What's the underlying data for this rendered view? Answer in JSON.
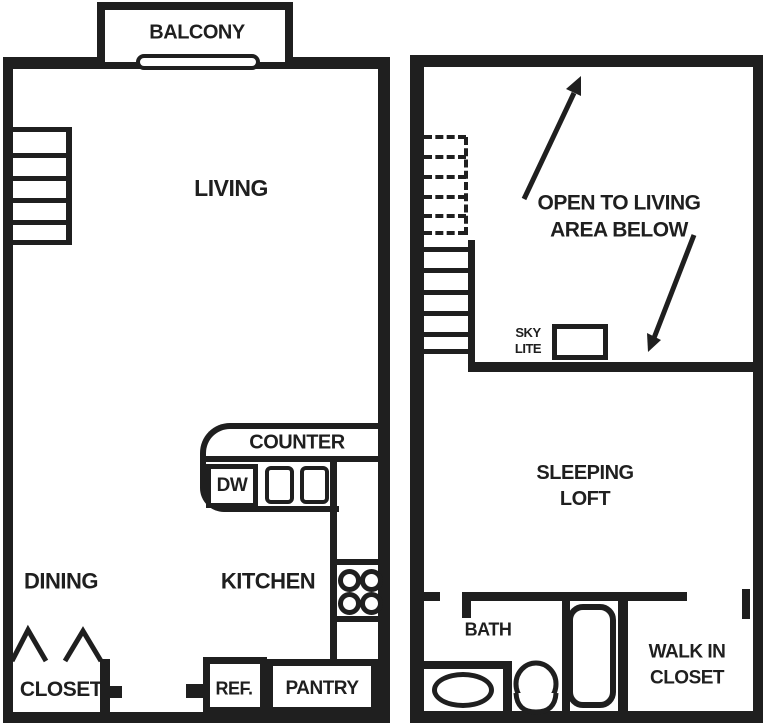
{
  "colors": {
    "ink": "#1f1f1f",
    "paper": "#ffffff"
  },
  "lower_floor": {
    "balcony": "BALCONY",
    "living": "LIVING",
    "counter": "COUNTER",
    "dishwasher": "DW",
    "kitchen": "KITCHEN",
    "dining": "DINING",
    "closet": "CLOSET",
    "refrigerator": "REF.",
    "pantry": "PANTRY"
  },
  "upper_floor": {
    "open_to_living_line1": "OPEN TO LIVING",
    "open_to_living_line2": "AREA BELOW",
    "skylight_line1": "SKY",
    "skylight_line2": "LITE",
    "sleeping_line1": "SLEEPING",
    "sleeping_line2": "LOFT",
    "bath": "BATH",
    "walk_in_line1": "WALK IN",
    "walk_in_line2": "CLOSET"
  }
}
